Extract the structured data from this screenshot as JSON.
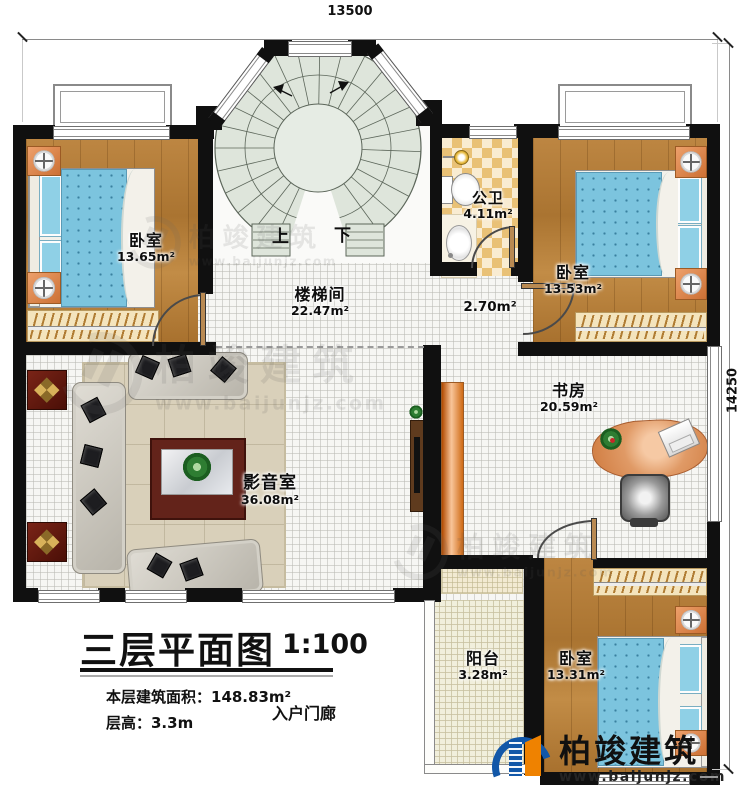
{
  "dimensions": {
    "top": "13500",
    "right": "14250"
  },
  "rooms": {
    "bedroom_top_left": {
      "name": "卧室",
      "area": "13.65m²"
    },
    "stairwell": {
      "name": "楼梯间",
      "area": "22.47m²"
    },
    "bathroom": {
      "name": "公卫",
      "area": "4.11m²"
    },
    "bedroom_top_right": {
      "name": "卧室",
      "area": "13.53m²"
    },
    "hallway": {
      "area": "2.70m²"
    },
    "study": {
      "name": "书房",
      "area": "20.59m²"
    },
    "media_room": {
      "name": "影音室",
      "area": "36.08m²"
    },
    "balcony": {
      "name": "阳台",
      "area": "3.28m²"
    },
    "bedroom_bottom_right": {
      "name": "卧室",
      "area": "13.31m²"
    },
    "porch": {
      "name": "入户门廊"
    }
  },
  "stairs": {
    "up": "上",
    "down": "下"
  },
  "title": {
    "main": "三层平面图",
    "scale": "1:100",
    "area_line": "本层建筑面积：148.83m²",
    "height_line": "层高：3.3m"
  },
  "branding": {
    "name": "柏竣建筑",
    "url": "www.baijunjz.com"
  },
  "watermark": {
    "name": "柏竣建筑",
    "url": "www.baijunjz.com"
  },
  "colors": {
    "wall": "#101010",
    "wood": "#b5803a",
    "bed": "#7cc4de",
    "stair": "#dee5db",
    "tile": "#e9c176",
    "brand_blue": "#1257a8",
    "brand_orange": "#ef8200"
  }
}
